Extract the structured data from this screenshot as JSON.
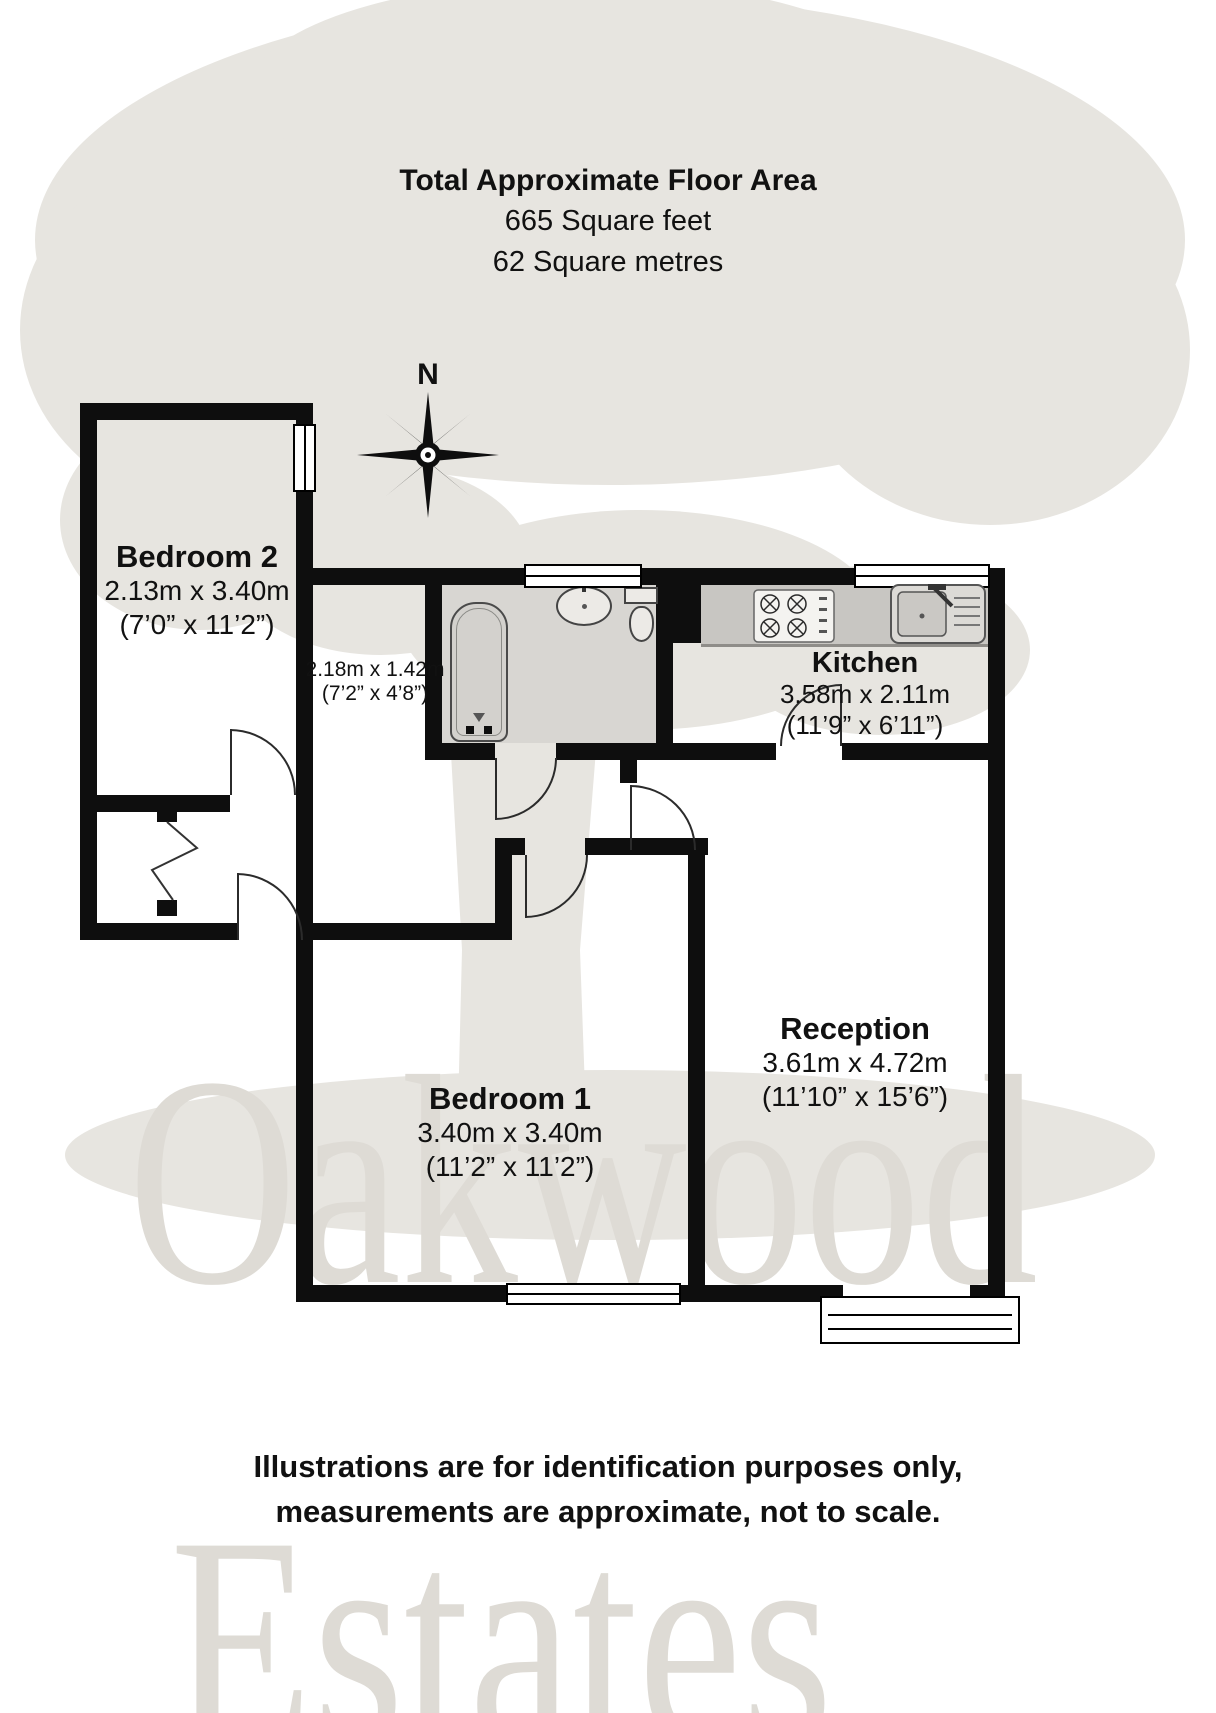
{
  "title": {
    "line1": "Total Approximate Floor Area",
    "line2": "665 Square feet",
    "line3": "62 Square metres"
  },
  "compass": {
    "north_label": "N"
  },
  "rooms": {
    "bedroom2": {
      "name": "Bedroom 2",
      "metric": "2.13m x 3.40m",
      "imperial": "(7’0” x 11’2”)"
    },
    "hallway": {
      "metric": "2.18m x 1.42m",
      "imperial": "(7’2” x 4’8”)"
    },
    "kitchen": {
      "name": "Kitchen",
      "metric": "3.58m x 2.11m",
      "imperial": "(11’9” x 6’11”)"
    },
    "reception": {
      "name": "Reception",
      "metric": "3.61m x 4.72m",
      "imperial": "(11’10” x 15’6”)"
    },
    "bedroom1": {
      "name": "Bedroom 1",
      "metric": "3.40m x 3.40m",
      "imperial": "(11’2” x 11’2”)"
    }
  },
  "watermark": {
    "word1": "Oakwood",
    "word2": "Estates"
  },
  "disclaimer": {
    "line1": "Illustrations are for identification purposes only,",
    "line2": "measurements are approximate, not to scale."
  },
  "colors": {
    "wall": "#0e0e0e",
    "tree": "#e7e5e0",
    "watermark_text": "#dedbd5"
  }
}
